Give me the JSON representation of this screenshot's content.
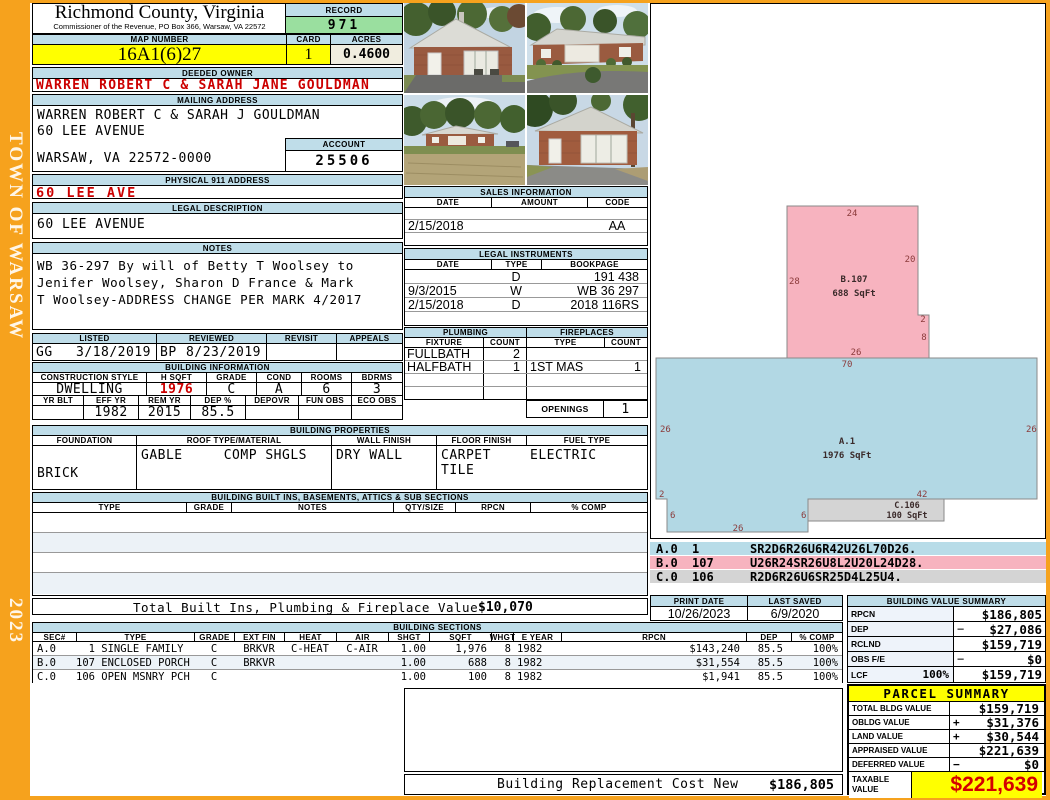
{
  "frame": {
    "town": "TOWN OF WARSAW",
    "year": "2023"
  },
  "header": {
    "county": "Richmond County, Virginia",
    "commissioner": "Commissioner of the Revenue, PO Box 366, Warsaw, VA 22572",
    "record_label": "RECORD",
    "record_value": "971",
    "map_label": "MAP NUMBER",
    "map_value": "16A1(6)27",
    "card_label": "CARD",
    "card_value": "1",
    "acres_label": "ACRES",
    "acres_value": "0.4600"
  },
  "owner": {
    "section_label": "DEEDED OWNER",
    "name": "WARREN ROBERT C & SARAH JANE GOULDMAN"
  },
  "mailing": {
    "section_label": "MAILING ADDRESS",
    "line1": "WARREN ROBERT C & SARAH J GOULDMAN",
    "line2": "60 LEE AVENUE",
    "line3": "WARSAW, VA 22572-0000",
    "account_label": "ACCOUNT",
    "account_value": "25506"
  },
  "physical_address": {
    "section_label": "PHYSICAL 911 ADDRESS",
    "value": "60 LEE AVE"
  },
  "legal_description": {
    "section_label": "LEGAL DESCRIPTION",
    "value": "60 LEE AVENUE"
  },
  "notes": {
    "section_label": "NOTES",
    "line1": "WB 36-297 By will of Betty T Woolsey to",
    "line2": "Jenifer Woolsey, Sharon D France & Mark",
    "line3": "T Woolsey-ADDRESS CHANGE PER MARK 4/2017"
  },
  "review": {
    "listed_label": "LISTED",
    "listed_initials": "GG",
    "listed_date": "3/18/2019",
    "reviewed_label": "REVIEWED",
    "reviewed_initials": "BP",
    "reviewed_date": "8/23/2019",
    "revisit_label": "REVISIT",
    "revisit_value": "",
    "appeals_label": "APPEALS",
    "appeals_value": ""
  },
  "building_info": {
    "section_label": "BUILDING INFORMATION",
    "row1_headers": [
      "CONSTRUCTION STYLE",
      "H SQFT",
      "GRADE",
      "COND",
      "ROOMS",
      "BDRMS"
    ],
    "style": "DWELLING",
    "h_sqft": "1976",
    "grade": "C",
    "cond": "A",
    "rooms": "6",
    "bdrms": "3",
    "row2_headers": [
      "YR BLT",
      "EFF YR",
      "REM YR",
      "DEP %",
      "DEPOVR",
      "FUN OBS",
      "ECO OBS"
    ],
    "yr_blt": "",
    "eff_yr": "1982",
    "rem_yr": "2015",
    "dep_pct": "85.5",
    "depovr": "",
    "fun_obs": "",
    "eco_obs": ""
  },
  "building_properties": {
    "section_label": "BUILDING PROPERTIES",
    "headers": [
      "FOUNDATION",
      "ROOF TYPE/MATERIAL",
      "WALL FINISH",
      "FLOOR FINISH",
      "FUEL TYPE"
    ],
    "foundation": "BRICK",
    "roof_type": "GABLE",
    "roof_material": "COMP SHGLS",
    "wall_finish": "DRY WALL",
    "floor_finish_1": "CARPET",
    "floor_finish_2": "TILE",
    "fuel_type": "ELECTRIC"
  },
  "built_ins": {
    "section_label": "BUILDING BUILT INS, BASEMENTS, ATTICS & SUB SECTIONS",
    "headers": [
      "TYPE",
      "GRADE",
      "NOTES",
      "QTY/SIZE",
      "RPCN",
      "% COMP"
    ]
  },
  "sales": {
    "section_label": "SALES INFORMATION",
    "headers": [
      "DATE",
      "AMOUNT",
      "CODE"
    ],
    "rows": [
      {
        "date": "",
        "amount": "",
        "code": ""
      },
      {
        "date": "2/15/2018",
        "amount": "",
        "code": "AA"
      },
      {
        "date": "",
        "amount": "",
        "code": ""
      }
    ]
  },
  "instruments": {
    "section_label": "LEGAL INSTRUMENTS",
    "headers": [
      "DATE",
      "TYPE",
      "BOOKPAGE"
    ],
    "rows": [
      {
        "date": "",
        "type": "D",
        "bookpage": "191 438"
      },
      {
        "date": "9/3/2015",
        "type": "W",
        "bookpage": "WB 36 297"
      },
      {
        "date": "2/15/2018",
        "type": "D",
        "bookpage": "2018 116RS"
      },
      {
        "date": "",
        "type": "",
        "bookpage": ""
      }
    ]
  },
  "plumbing": {
    "section_label": "PLUMBING",
    "fixture_label": "FIXTURE",
    "count_label": "COUNT",
    "rows": [
      {
        "fixture": "FULLBATH",
        "count": "2"
      },
      {
        "fixture": "HALFBATH",
        "count": "1"
      },
      {
        "fixture": "",
        "count": ""
      },
      {
        "fixture": "",
        "count": ""
      }
    ]
  },
  "fireplaces": {
    "section_label": "FIREPLACES",
    "type_label": "TYPE",
    "count_label": "COUNT",
    "rows": [
      {
        "type": "",
        "count": ""
      },
      {
        "type": "1ST MAS",
        "count": "1"
      },
      {
        "type": "",
        "count": ""
      },
      {
        "type": "",
        "count": ""
      }
    ],
    "openings_label": "OPENINGS",
    "openings_value": "1"
  },
  "totals": {
    "built_ins_label": "Total Built Ins, Plumbing & Fireplace Value",
    "built_ins_value": "$10,070",
    "replacement_label": "Building Replacement Cost New",
    "replacement_value": "$186,805"
  },
  "sketch": {
    "shapes": [
      {
        "id": "A.1",
        "sqft": "1976 SqFt"
      },
      {
        "id": "B.107",
        "sqft": "688 SqFt"
      },
      {
        "id": "C.106",
        "sqft": "100 SqFt"
      }
    ],
    "dims": {
      "pink_top": "24",
      "pink_right": "20",
      "pink_left": "28",
      "pink_notch": "2",
      "pink_lower": "8",
      "pink_bottom": "26",
      "blue_top": "70",
      "blue_left": "26",
      "blue_right": "26",
      "blue_notch": "2",
      "blue_nleft": "6",
      "blue_nbottom": "26",
      "blue_nright": "6",
      "blue_bottom_right": "42"
    },
    "legend": [
      {
        "sec": "A.0",
        "code": "1",
        "vector": "SR2D6R26U6R42U26L70D26."
      },
      {
        "sec": "B.0",
        "code": "107",
        "vector": "U26R24SR26U8L2U20L24D28."
      },
      {
        "sec": "C.0",
        "code": "106",
        "vector": "R2D6R26U6SR25D4L25U4."
      }
    ]
  },
  "dates": {
    "print_label": "PRINT DATE",
    "print_value": "10/26/2023",
    "saved_label": "LAST SAVED",
    "saved_value": "6/9/2020"
  },
  "value_summary": {
    "section_label": "BUILDING VALUE SUMMARY",
    "rows": [
      {
        "label": "RPCN",
        "pct": "",
        "op": "",
        "value": "$186,805"
      },
      {
        "label": "DEP",
        "pct": "",
        "op": "−",
        "value": "$27,086"
      },
      {
        "label": "RCLND",
        "pct": "",
        "op": "",
        "value": "$159,719"
      },
      {
        "label": "OBS F/E",
        "pct": "",
        "op": "−",
        "value": "$0"
      },
      {
        "label": "LCF",
        "pct": "100%",
        "op": "",
        "value": "$159,719"
      }
    ]
  },
  "sections_table": {
    "section_label": "BUILDING SECTIONS",
    "headers": [
      "SEC#",
      "TYPE",
      "GRADE",
      "EXT FIN",
      "HEAT",
      "AIR",
      "SHGT",
      "SQFT",
      "WHGT",
      "E YEAR",
      "RPCN",
      "DEP",
      "% COMP"
    ],
    "rows": [
      {
        "sec": "A.0",
        "type": "  1 SINGLE FAMILY",
        "grade": "C",
        "ext_fin": "BRKVR",
        "heat": "C-HEAT",
        "air": "C-AIR",
        "shgt": "1.00",
        "sqft": "1,976",
        "whgt": "8",
        "eyear": "1982",
        "rpcn": "$143,240",
        "dep": "85.5",
        "comp": "100%"
      },
      {
        "sec": "B.0",
        "type": "107 ENCLOSED PORCH",
        "grade": "C",
        "ext_fin": "BRKVR",
        "heat": "",
        "air": "",
        "shgt": "1.00",
        "sqft": "688",
        "whgt": "8",
        "eyear": "1982",
        "rpcn": "$31,554",
        "dep": "85.5",
        "comp": "100%"
      },
      {
        "sec": "C.0",
        "type": "106 OPEN MSNRY PCH",
        "grade": "C",
        "ext_fin": "",
        "heat": "",
        "air": "",
        "shgt": "1.00",
        "sqft": "100",
        "whgt": "8",
        "eyear": "1982",
        "rpcn": "$1,941",
        "dep": "85.5",
        "comp": "100%"
      }
    ]
  },
  "parcel": {
    "section_label": "PARCEL SUMMARY",
    "rows": [
      {
        "label": "TOTAL BLDG VALUE",
        "op": "",
        "value": "$159,719"
      },
      {
        "label": "OBLDG VALUE",
        "op": "+",
        "value": "$31,376"
      },
      {
        "label": "LAND VALUE",
        "op": "+",
        "value": "$30,544"
      },
      {
        "label": "APPRAISED VALUE",
        "op": "",
        "value": "$221,639"
      },
      {
        "label": "DEFERRED VALUE",
        "op": "−",
        "value": "$0"
      }
    ],
    "taxable_label": "TAXABLE VALUE",
    "taxable_value": "$221,639"
  },
  "photos": {
    "items": [
      "house-front-view",
      "house-angle-view",
      "house-distant-view",
      "house-porch-view"
    ]
  },
  "colors": {
    "accent_orange": "#F6A21D",
    "header_blue": "#BFDDE9",
    "record_green": "#9ADF9F",
    "highlight_yellow": "#FFFF00",
    "value_red": "#CC0000",
    "sketch_pink": "#F7B3BF",
    "sketch_blue": "#B2D8E4",
    "sketch_gray": "#D4D4D4"
  }
}
